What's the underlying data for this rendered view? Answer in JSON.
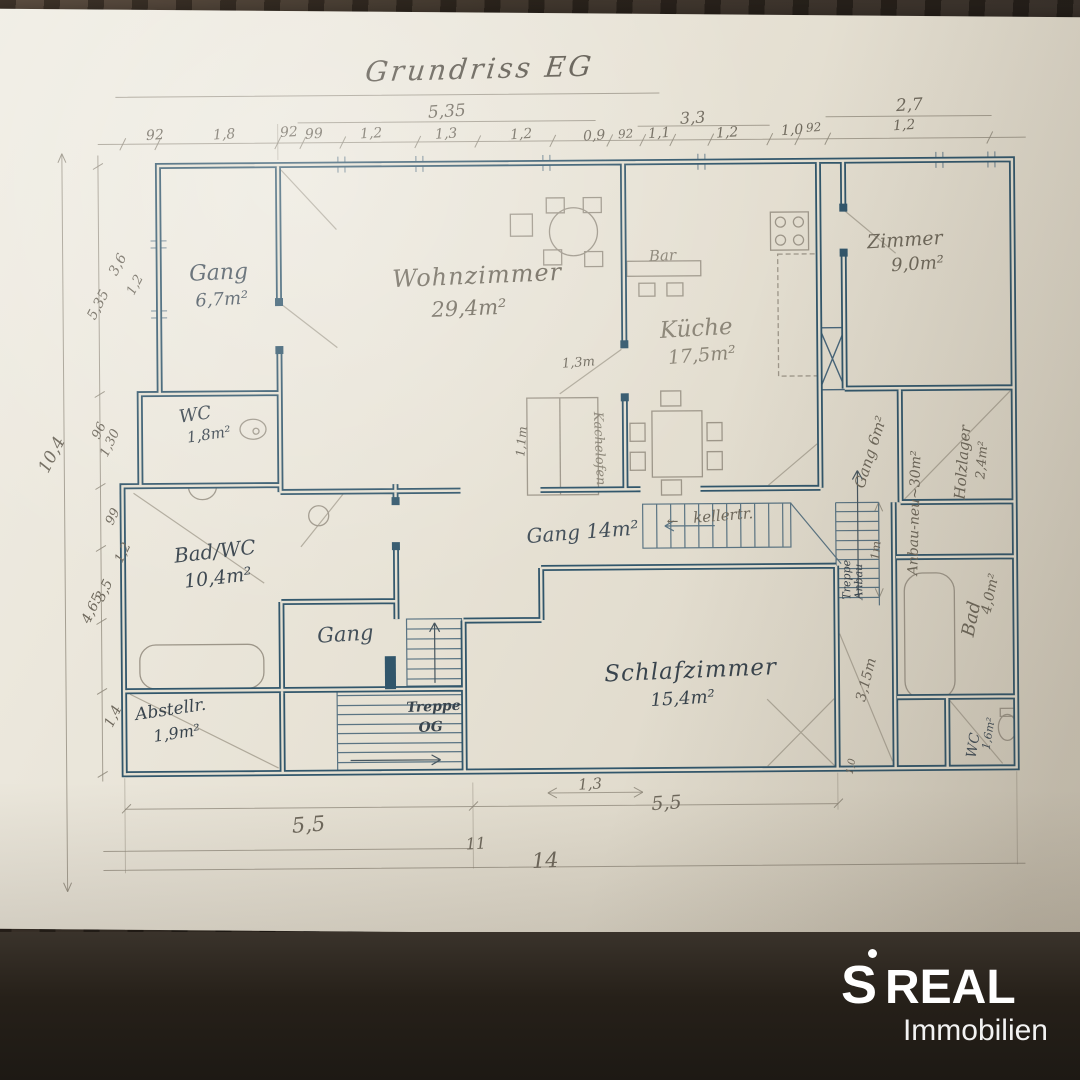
{
  "title": "Grundriss EG",
  "rooms": {
    "gang_og": {
      "name": "Gang",
      "area": "6,7m²"
    },
    "wohnzimmer": {
      "name": "Wohnzimmer",
      "area": "29,4m²"
    },
    "kueche": {
      "name": "Küche",
      "area": "17,5m²"
    },
    "bar": {
      "name": "Bar"
    },
    "zimmer": {
      "name": "Zimmer",
      "area": "9,0m²"
    },
    "wc_links": {
      "name": "WC",
      "area": "1,8m²"
    },
    "bad_wc": {
      "name": "Bad/WC",
      "area": "10,4m²"
    },
    "gang_mitte": {
      "name": "Gang 14m²"
    },
    "kellertreppe": {
      "name": "kellertr."
    },
    "kachelofen": {
      "name": "Kachelofen"
    },
    "schlafzimmer": {
      "name": "Schlafzimmer",
      "area": "15,4m²"
    },
    "gang_unten": {
      "name": "Gang"
    },
    "treppe_og": {
      "line1": "Treppe",
      "line2": "OG"
    },
    "abstellraum": {
      "name": "Abstellr.",
      "area": "1,9m²"
    },
    "gang_rechts": {
      "name": "Gang 6m²"
    },
    "anbau": {
      "name": "Anbau-neu~30m²"
    },
    "holzlager": {
      "name": "Holzlager",
      "area": "2,4m²"
    },
    "treppe_anbau": {
      "line1": "Treppe",
      "line2": "Anbau"
    },
    "bad_rechts": {
      "name": "Bad",
      "area": "4,0m²"
    },
    "wc_rechts": {
      "name": "WC",
      "area": "1,6m²"
    }
  },
  "dimensions": {
    "top": {
      "d1": "92",
      "d2": "1,8",
      "d3": "92",
      "d4": "99",
      "d5": "1,2",
      "d6": "5,35",
      "d7": "1,3",
      "d8": "1,2",
      "d9": "0,9",
      "d10": "92",
      "d11": "1,1",
      "d12": "3,3",
      "d13": "1,2",
      "d14": "1,0",
      "d15": "92",
      "d16": "2,7",
      "d17": "1,2"
    },
    "left": {
      "d1": "3,6",
      "d2": "1,2",
      "d3": "5,35",
      "d4": "10,4",
      "d5": "96",
      "d6": "1,30",
      "d7": "99",
      "d8": "1,2",
      "d9": "3,5",
      "d10": "4,65",
      "d11": "1,4"
    },
    "bottom": {
      "d1": "5,5",
      "d2": "1,3",
      "d3": "5,5",
      "d4": "11",
      "d5": "14"
    },
    "inner": {
      "d1": "1,3m",
      "d2": "1,1m",
      "d3": "1m",
      "d4": "3,15m",
      "d5": "1,0"
    }
  },
  "arrows": {
    "kellertr": "←"
  },
  "logo": {
    "s": "S",
    "brand": "REAL",
    "subtitle": "Immobilien"
  },
  "colors": {
    "ink": "#31566b",
    "pencil": "#6e685b",
    "paper": "#e6e1d3",
    "logo_bg": "#262019",
    "logo_text": "#ffffff"
  }
}
